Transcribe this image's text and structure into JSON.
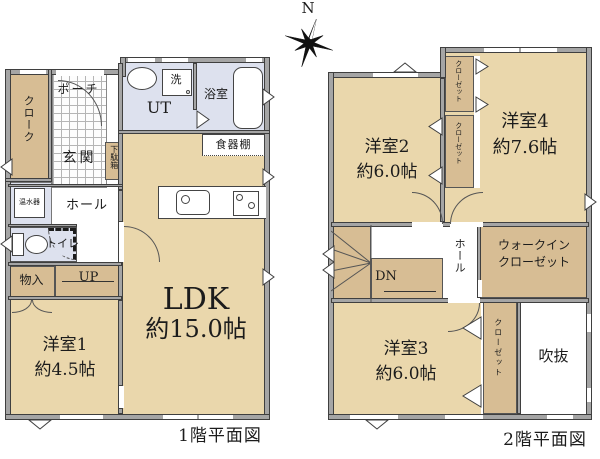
{
  "compass": {
    "north_label": "N"
  },
  "floor1": {
    "caption": "1階平面図",
    "labels": {
      "porch": "ポーチ",
      "cloak": "クローク",
      "entrance": "玄関",
      "shoe_cabinet": "下駄箱",
      "utility": "UT",
      "washer": "洗",
      "bathroom": "浴室",
      "cupboard": "食器棚",
      "water_heater": "温水器",
      "hall": "ホール",
      "toilet": "トイレ",
      "storage": "物入",
      "stairs": "UP",
      "ldk_name": "LDK",
      "ldk_size": "約15.0帖",
      "room1_name": "洋室1",
      "room1_size": "約4.5帖"
    }
  },
  "floor2": {
    "caption": "2階平面図",
    "labels": {
      "room2_name": "洋室2",
      "room2_size": "約6.0帖",
      "room4_name": "洋室4",
      "room4_size": "約7.6帖",
      "closet": "クローゼット",
      "wic_line1": "ウォークイン",
      "wic_line2": "クローゼット",
      "hall": "ホール",
      "stairs": "DN",
      "room3_name": "洋室3",
      "room3_size": "約6.0帖",
      "void": "吹抜"
    }
  },
  "colors": {
    "room_beige": "#ead7ac",
    "closet_tan": "#d7bd94",
    "wet_area_lavender": "#dde1ee",
    "wall_gray": "#a5a5a5",
    "line": "#3f3f3f"
  }
}
